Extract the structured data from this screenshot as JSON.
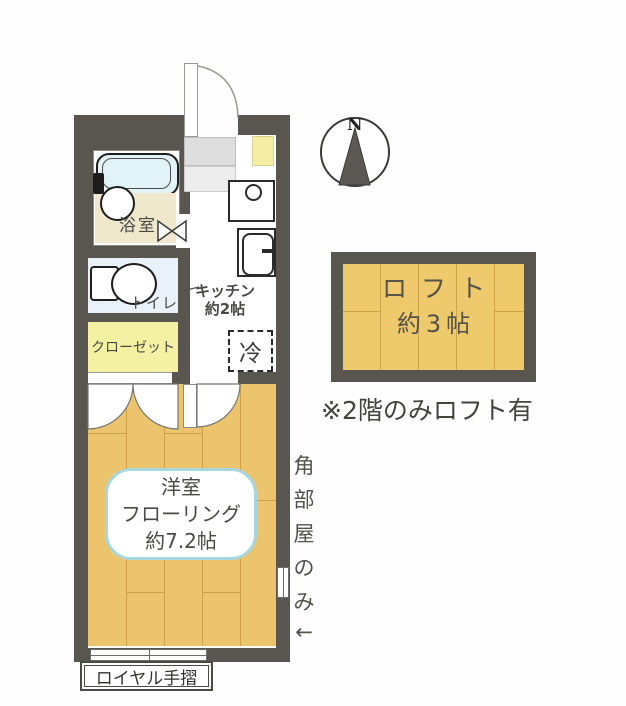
{
  "floorplan": {
    "compass": {
      "north_label": "N"
    },
    "rooms": {
      "bathroom_label": "浴室",
      "toilet_label": "トイレ",
      "closet_label": "クローゼット",
      "kitchen_label": "キッチン",
      "kitchen_size": "約2帖",
      "fridge_label": "冷",
      "main_room_type": "洋室",
      "main_room_floor": "フローリング",
      "main_room_size": "約7.2帖"
    },
    "loft": {
      "label": "ロフト",
      "size": "約3帖",
      "note": "※2階のみロフト有"
    },
    "annotations": {
      "corner_chars": [
        "角",
        "部",
        "屋",
        "の",
        "み",
        "←"
      ],
      "handrail_label": "ロイヤル手摺"
    },
    "colors": {
      "wall": "#59564f",
      "wood_floor": "#ecc46d",
      "loft_floor": "#eeca6c",
      "closet_yellow": "#f5f1a3",
      "shoe_box_yellow": "#f4eea4",
      "bath_floor_cream": "#efe8cc",
      "tub_blue": "#e1f3f6",
      "toilet_room_blue": "#e9f2f8",
      "room_label_border": "#a7d7de",
      "genkan_gray": "#dedede"
    }
  }
}
